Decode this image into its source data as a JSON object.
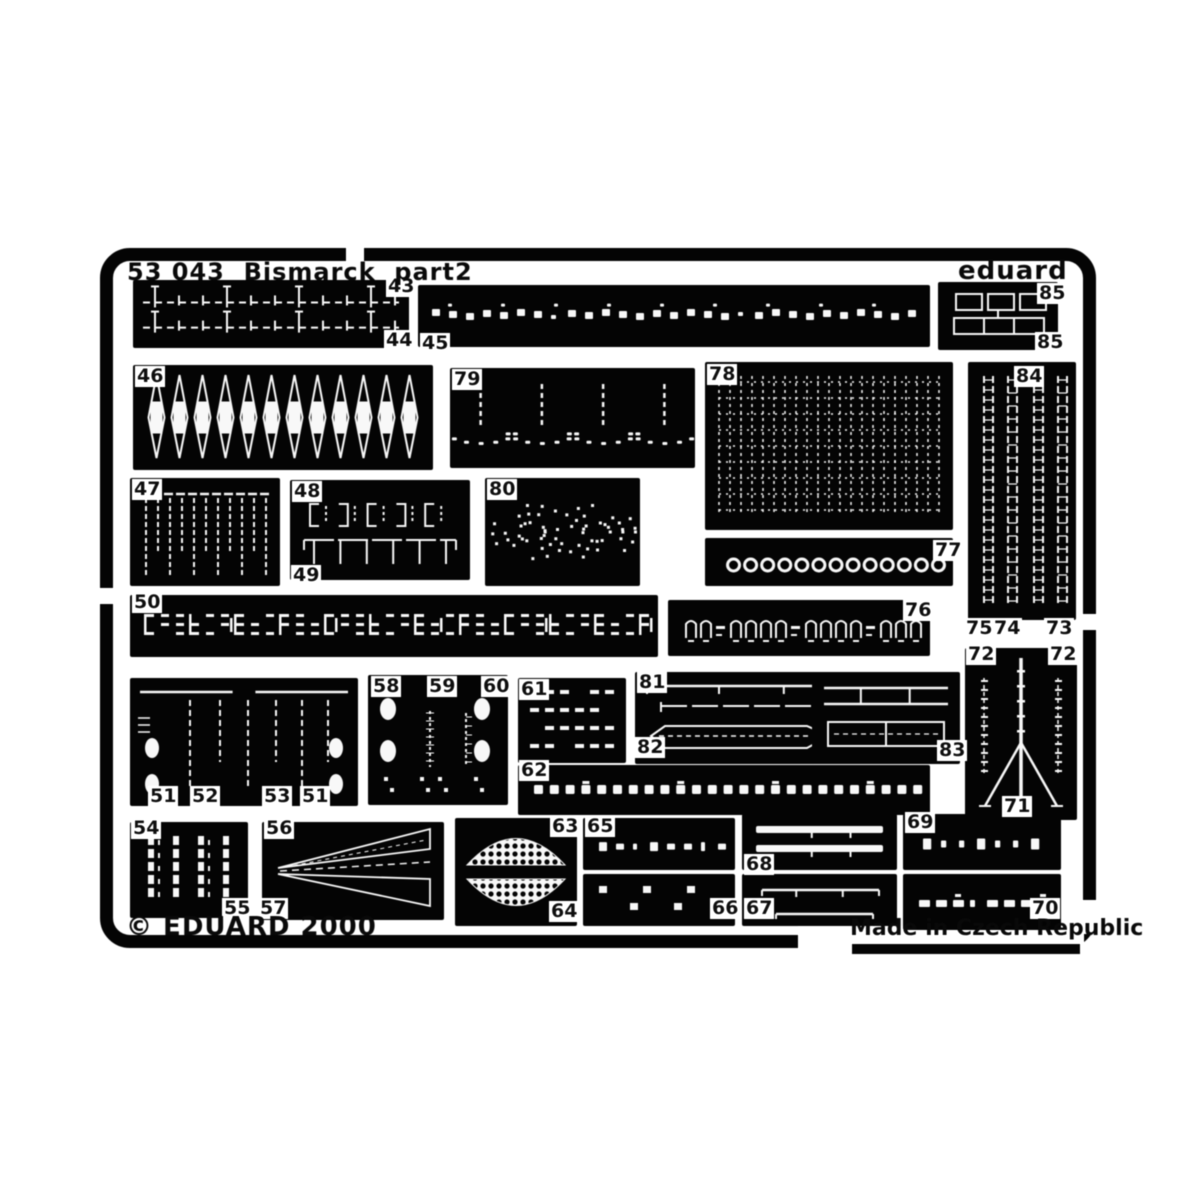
{
  "title_bar": {
    "set_title": "53 043  Bismarck  part2",
    "brand": "eduard"
  },
  "footer": {
    "copyright": "© EDUARD 2000",
    "origin": "Made in Czech Republic"
  },
  "colors": {
    "metal": "#0b0b0b",
    "etch": "#f1f1f1",
    "paper": "#ffffff"
  },
  "fret": {
    "parts": [
      {
        "id": "43-44",
        "pattern": "railing2",
        "x": 133,
        "y": 280,
        "w": 276,
        "h": 68
      },
      {
        "id": "45",
        "pattern": "chain",
        "x": 418,
        "y": 285,
        "w": 512,
        "h": 62
      },
      {
        "id": "85",
        "pattern": "windows",
        "x": 938,
        "y": 282,
        "w": 120,
        "h": 68
      },
      {
        "id": "46",
        "pattern": "marquise",
        "x": 133,
        "y": 365,
        "w": 300,
        "h": 105
      },
      {
        "id": "79",
        "pattern": "fans",
        "x": 450,
        "y": 368,
        "w": 245,
        "h": 100
      },
      {
        "id": "78",
        "pattern": "mesh",
        "x": 705,
        "y": 362,
        "w": 248,
        "h": 168
      },
      {
        "id": "84",
        "pattern": "vladders",
        "x": 968,
        "y": 362,
        "w": 108,
        "h": 258
      },
      {
        "id": "47",
        "pattern": "comb",
        "x": 130,
        "y": 478,
        "w": 150,
        "h": 108
      },
      {
        "id": "48-49",
        "pattern": "brackets",
        "x": 290,
        "y": 480,
        "w": 180,
        "h": 100
      },
      {
        "id": "80",
        "pattern": "speckles",
        "x": 485,
        "y": 478,
        "w": 155,
        "h": 108
      },
      {
        "id": "77",
        "pattern": "circles",
        "x": 705,
        "y": 538,
        "w": 248,
        "h": 48
      },
      {
        "id": "50",
        "pattern": "glyphrow",
        "x": 130,
        "y": 595,
        "w": 528,
        "h": 62
      },
      {
        "id": "76",
        "pattern": "archrow",
        "x": 668,
        "y": 600,
        "w": 262,
        "h": 56
      },
      {
        "id": "51-53",
        "pattern": "davits",
        "x": 130,
        "y": 678,
        "w": 228,
        "h": 128
      },
      {
        "id": "58-60",
        "pattern": "blobgrid",
        "x": 368,
        "y": 675,
        "w": 140,
        "h": 130
      },
      {
        "id": "61",
        "pattern": "dashgrid",
        "x": 518,
        "y": 678,
        "w": 108,
        "h": 85
      },
      {
        "id": "81-82",
        "pattern": "boats81",
        "x": 635,
        "y": 672,
        "w": 240,
        "h": 92
      },
      {
        "id": "83",
        "pattern": "boats83",
        "x": 812,
        "y": 672,
        "w": 148,
        "h": 92
      },
      {
        "id": "62",
        "pattern": "dotrow",
        "x": 518,
        "y": 765,
        "w": 412,
        "h": 50
      },
      {
        "id": "71-72",
        "pattern": "tripod",
        "x": 965,
        "y": 648,
        "w": 112,
        "h": 172
      },
      {
        "id": "54-55",
        "pattern": "vstripes",
        "x": 130,
        "y": 822,
        "w": 118,
        "h": 96
      },
      {
        "id": "56-57",
        "pattern": "wedges",
        "x": 262,
        "y": 822,
        "w": 182,
        "h": 98
      },
      {
        "id": "63-64",
        "pattern": "lens",
        "x": 455,
        "y": 818,
        "w": 122,
        "h": 108
      },
      {
        "id": "65",
        "pattern": "smalldash",
        "x": 583,
        "y": 818,
        "w": 152,
        "h": 52
      },
      {
        "id": "66",
        "pattern": "sqdots",
        "x": 583,
        "y": 874,
        "w": 152,
        "h": 52
      },
      {
        "id": "68",
        "pattern": "twobars",
        "x": 742,
        "y": 814,
        "w": 155,
        "h": 56
      },
      {
        "id": "67",
        "pattern": "twolines",
        "x": 742,
        "y": 874,
        "w": 155,
        "h": 52
      },
      {
        "id": "69",
        "pattern": "dotdash",
        "x": 903,
        "y": 814,
        "w": 158,
        "h": 56
      },
      {
        "id": "70",
        "pattern": "dashrow",
        "x": 903,
        "y": 874,
        "w": 158,
        "h": 56
      }
    ],
    "labels": [
      {
        "text": "43",
        "x": 386,
        "y": 276
      },
      {
        "text": "44",
        "x": 384,
        "y": 330
      },
      {
        "text": "45",
        "x": 420,
        "y": 333
      },
      {
        "text": "85",
        "x": 1037,
        "y": 283
      },
      {
        "text": "85",
        "x": 1035,
        "y": 332
      },
      {
        "text": "46",
        "x": 135,
        "y": 366
      },
      {
        "text": "79",
        "x": 452,
        "y": 369
      },
      {
        "text": "78",
        "x": 707,
        "y": 364
      },
      {
        "text": "84",
        "x": 1014,
        "y": 366
      },
      {
        "text": "47",
        "x": 132,
        "y": 479
      },
      {
        "text": "48",
        "x": 292,
        "y": 481
      },
      {
        "text": "49",
        "x": 291,
        "y": 565
      },
      {
        "text": "80",
        "x": 487,
        "y": 479
      },
      {
        "text": "77",
        "x": 933,
        "y": 540
      },
      {
        "text": "50",
        "x": 132,
        "y": 592
      },
      {
        "text": "76",
        "x": 903,
        "y": 600
      },
      {
        "text": "51",
        "x": 148,
        "y": 786
      },
      {
        "text": "52",
        "x": 190,
        "y": 786
      },
      {
        "text": "53",
        "x": 262,
        "y": 786
      },
      {
        "text": "51",
        "x": 300,
        "y": 786
      },
      {
        "text": "58",
        "x": 371,
        "y": 676
      },
      {
        "text": "59",
        "x": 427,
        "y": 676
      },
      {
        "text": "60",
        "x": 481,
        "y": 676
      },
      {
        "text": "61",
        "x": 519,
        "y": 679
      },
      {
        "text": "81",
        "x": 637,
        "y": 672
      },
      {
        "text": "82",
        "x": 635,
        "y": 737
      },
      {
        "text": "83",
        "x": 937,
        "y": 740
      },
      {
        "text": "62",
        "x": 519,
        "y": 760
      },
      {
        "text": "72",
        "x": 966,
        "y": 644
      },
      {
        "text": "72",
        "x": 1048,
        "y": 644
      },
      {
        "text": "71",
        "x": 1002,
        "y": 796
      },
      {
        "text": "75",
        "x": 964,
        "y": 618
      },
      {
        "text": "74",
        "x": 992,
        "y": 618
      },
      {
        "text": "73",
        "x": 1044,
        "y": 618
      },
      {
        "text": "54",
        "x": 131,
        "y": 818
      },
      {
        "text": "55",
        "x": 222,
        "y": 898
      },
      {
        "text": "56",
        "x": 264,
        "y": 818
      },
      {
        "text": "57",
        "x": 258,
        "y": 898
      },
      {
        "text": "63",
        "x": 550,
        "y": 816
      },
      {
        "text": "64",
        "x": 549,
        "y": 901
      },
      {
        "text": "65",
        "x": 585,
        "y": 816
      },
      {
        "text": "66",
        "x": 710,
        "y": 898
      },
      {
        "text": "68",
        "x": 744,
        "y": 854
      },
      {
        "text": "67",
        "x": 744,
        "y": 898
      },
      {
        "text": "69",
        "x": 905,
        "y": 812
      },
      {
        "text": "70",
        "x": 1030,
        "y": 898
      }
    ]
  }
}
